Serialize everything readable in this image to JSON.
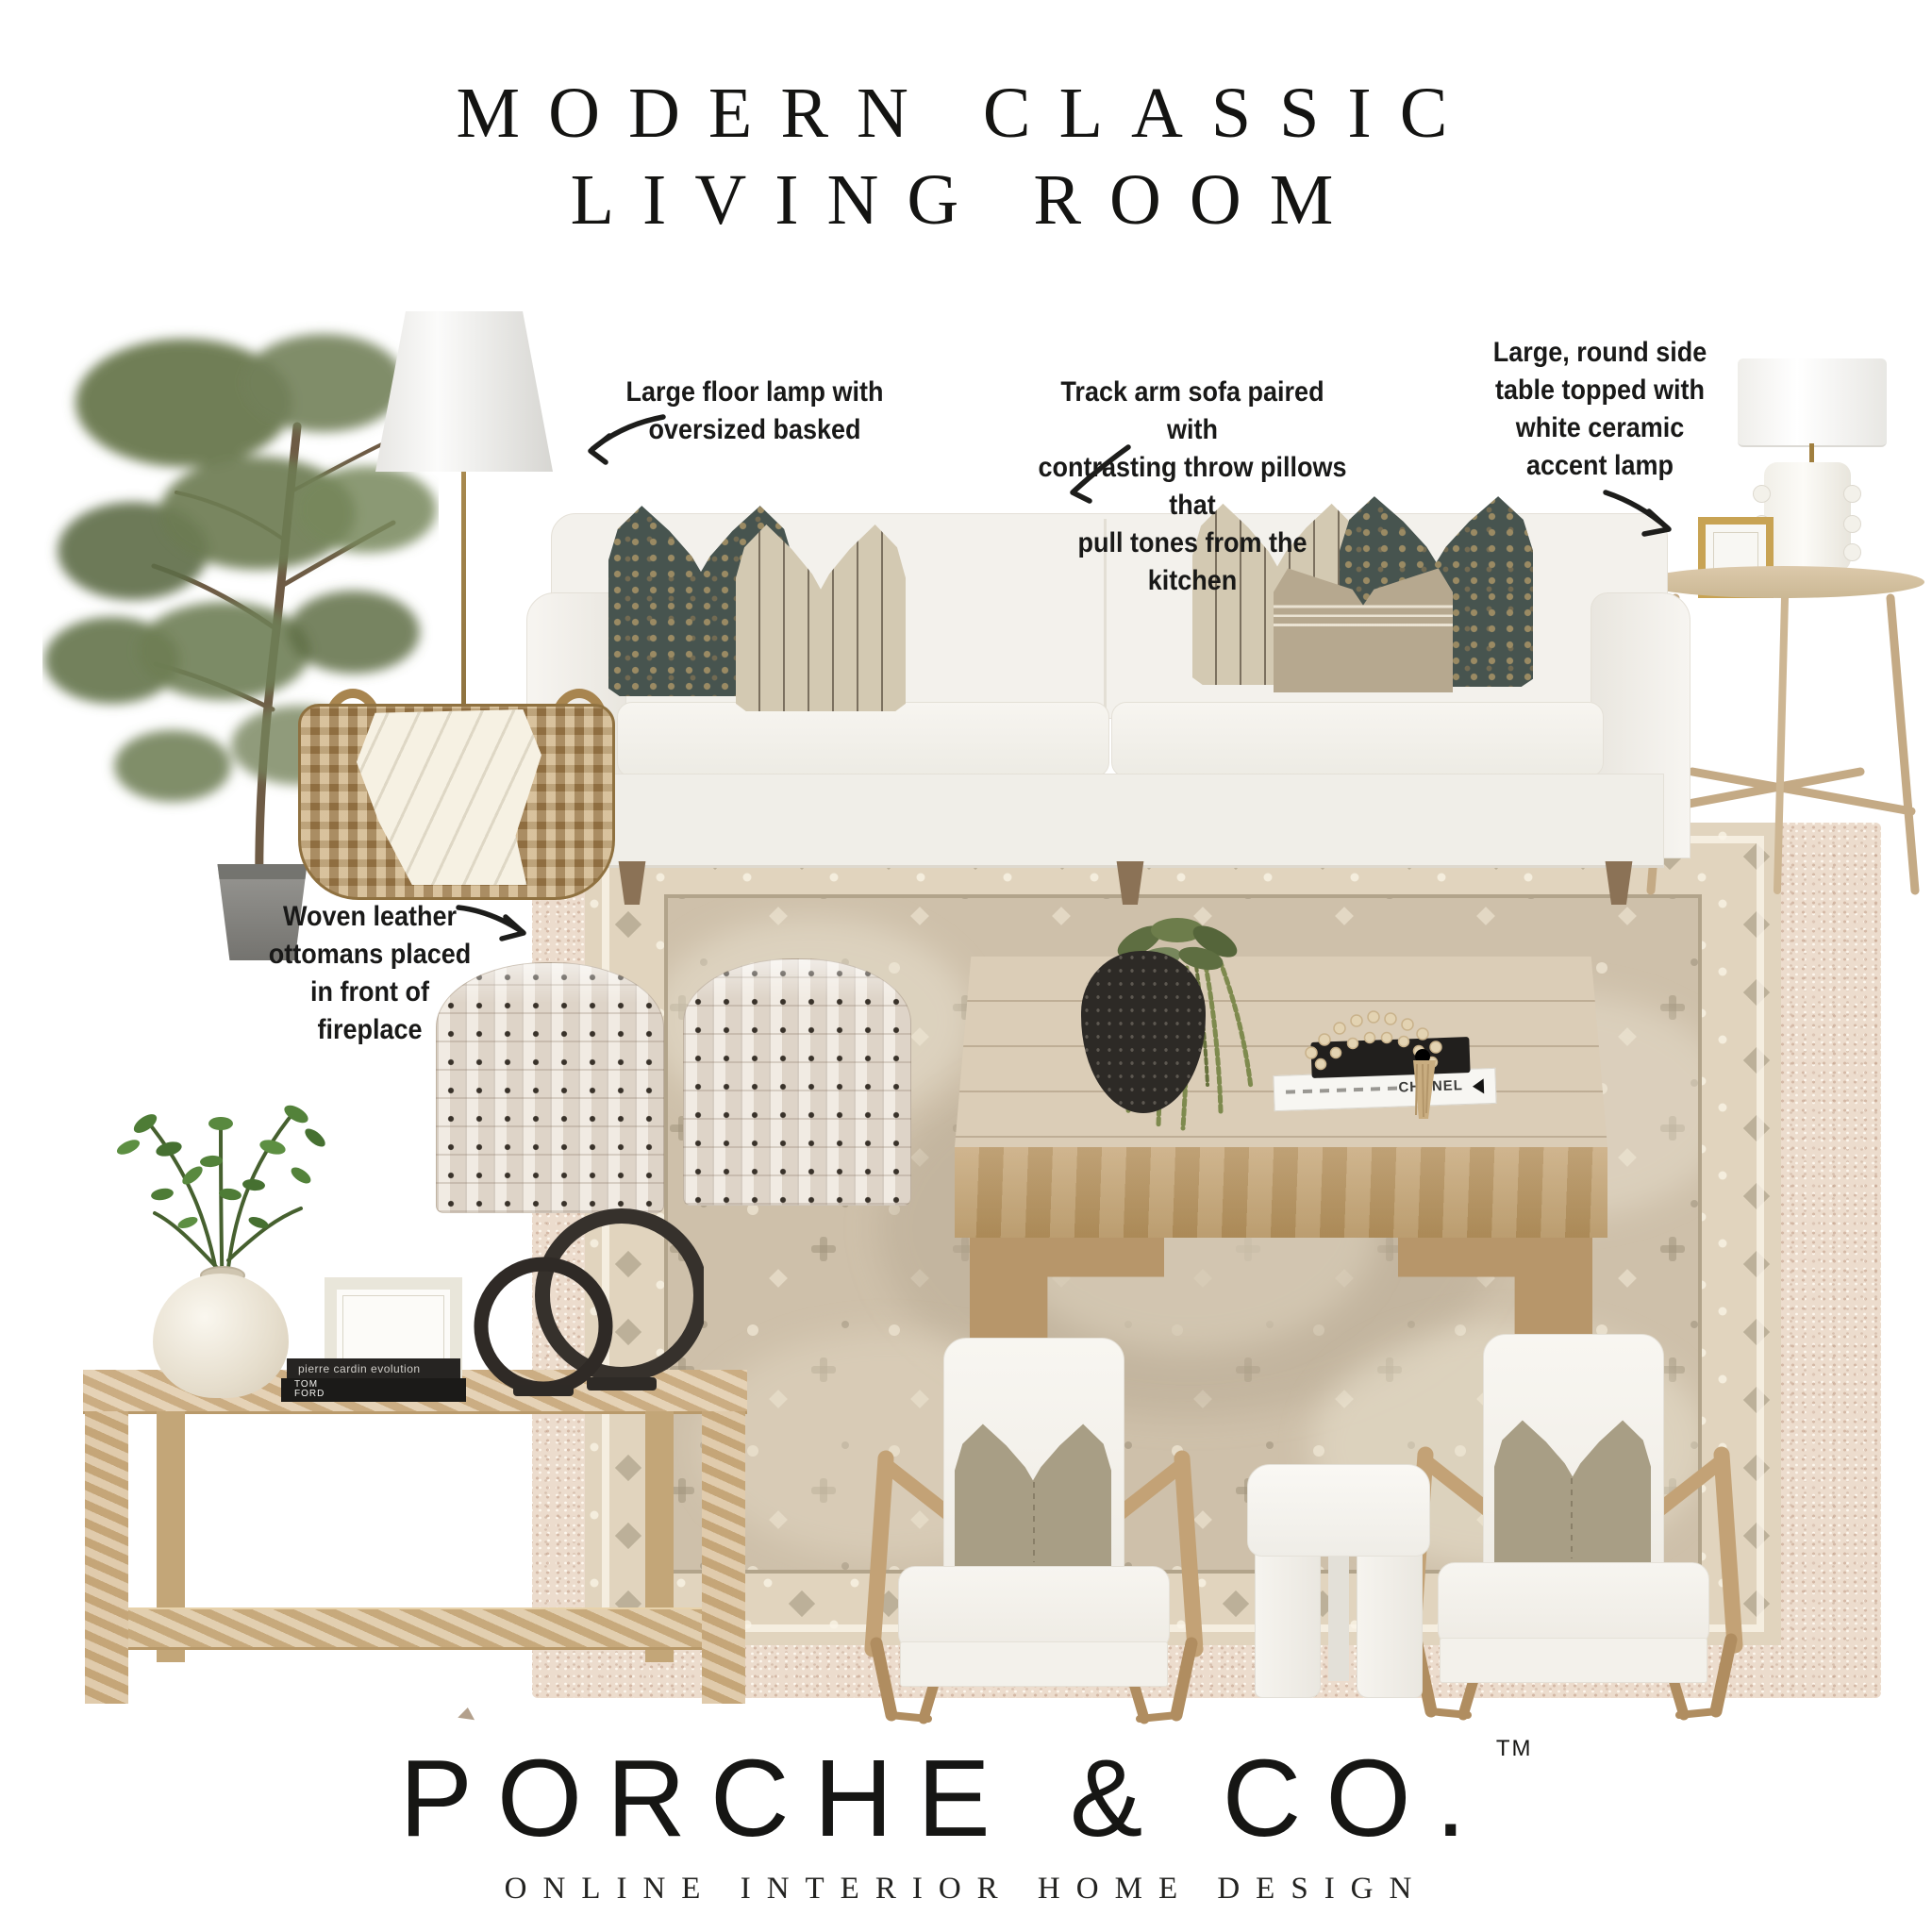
{
  "title": {
    "line1": "MODERN CLASSIC",
    "line2": "LIVING ROOM"
  },
  "annotations": {
    "floor_lamp": {
      "lines": [
        "Large floor lamp with",
        "oversized basked"
      ]
    },
    "sofa": {
      "lines": [
        "Track arm sofa paired with",
        "contrasting throw pillows that",
        "pull tones from the kitchen"
      ]
    },
    "side_table": {
      "lines": [
        "Large, round side",
        "table topped with",
        "white ceramic",
        "accent lamp"
      ]
    },
    "ottomans": {
      "lines": [
        "Woven leather",
        "ottomans placed",
        "in front of",
        "fireplace"
      ]
    }
  },
  "decor": {
    "books": {
      "console_top": "pierre cardin evolution",
      "console_bottom": "TOM FORD",
      "coffee_table": "CHANEL"
    }
  },
  "brand": {
    "name": "PORCHE & CO.",
    "trademark": "TM",
    "tagline": "ONLINE INTERIOR HOME DESIGN"
  },
  "palette": {
    "background": "#ffffff",
    "ink": "#1b1b19",
    "sofa": "#f2f0ea",
    "wood_oak": "#c9a97c",
    "wood_light": "#dabf96",
    "pillow_navy": "#47544f",
    "pillow_flax": "#d3c9b2",
    "pillow_tan": "#b6a88f",
    "rug_field": "#cec0aa",
    "rug_border": "#e1d4be",
    "rug_outer": "#ecdccd",
    "greenery": "#617147",
    "basket": "#b3905a",
    "sculpture_black": "#35302b"
  }
}
